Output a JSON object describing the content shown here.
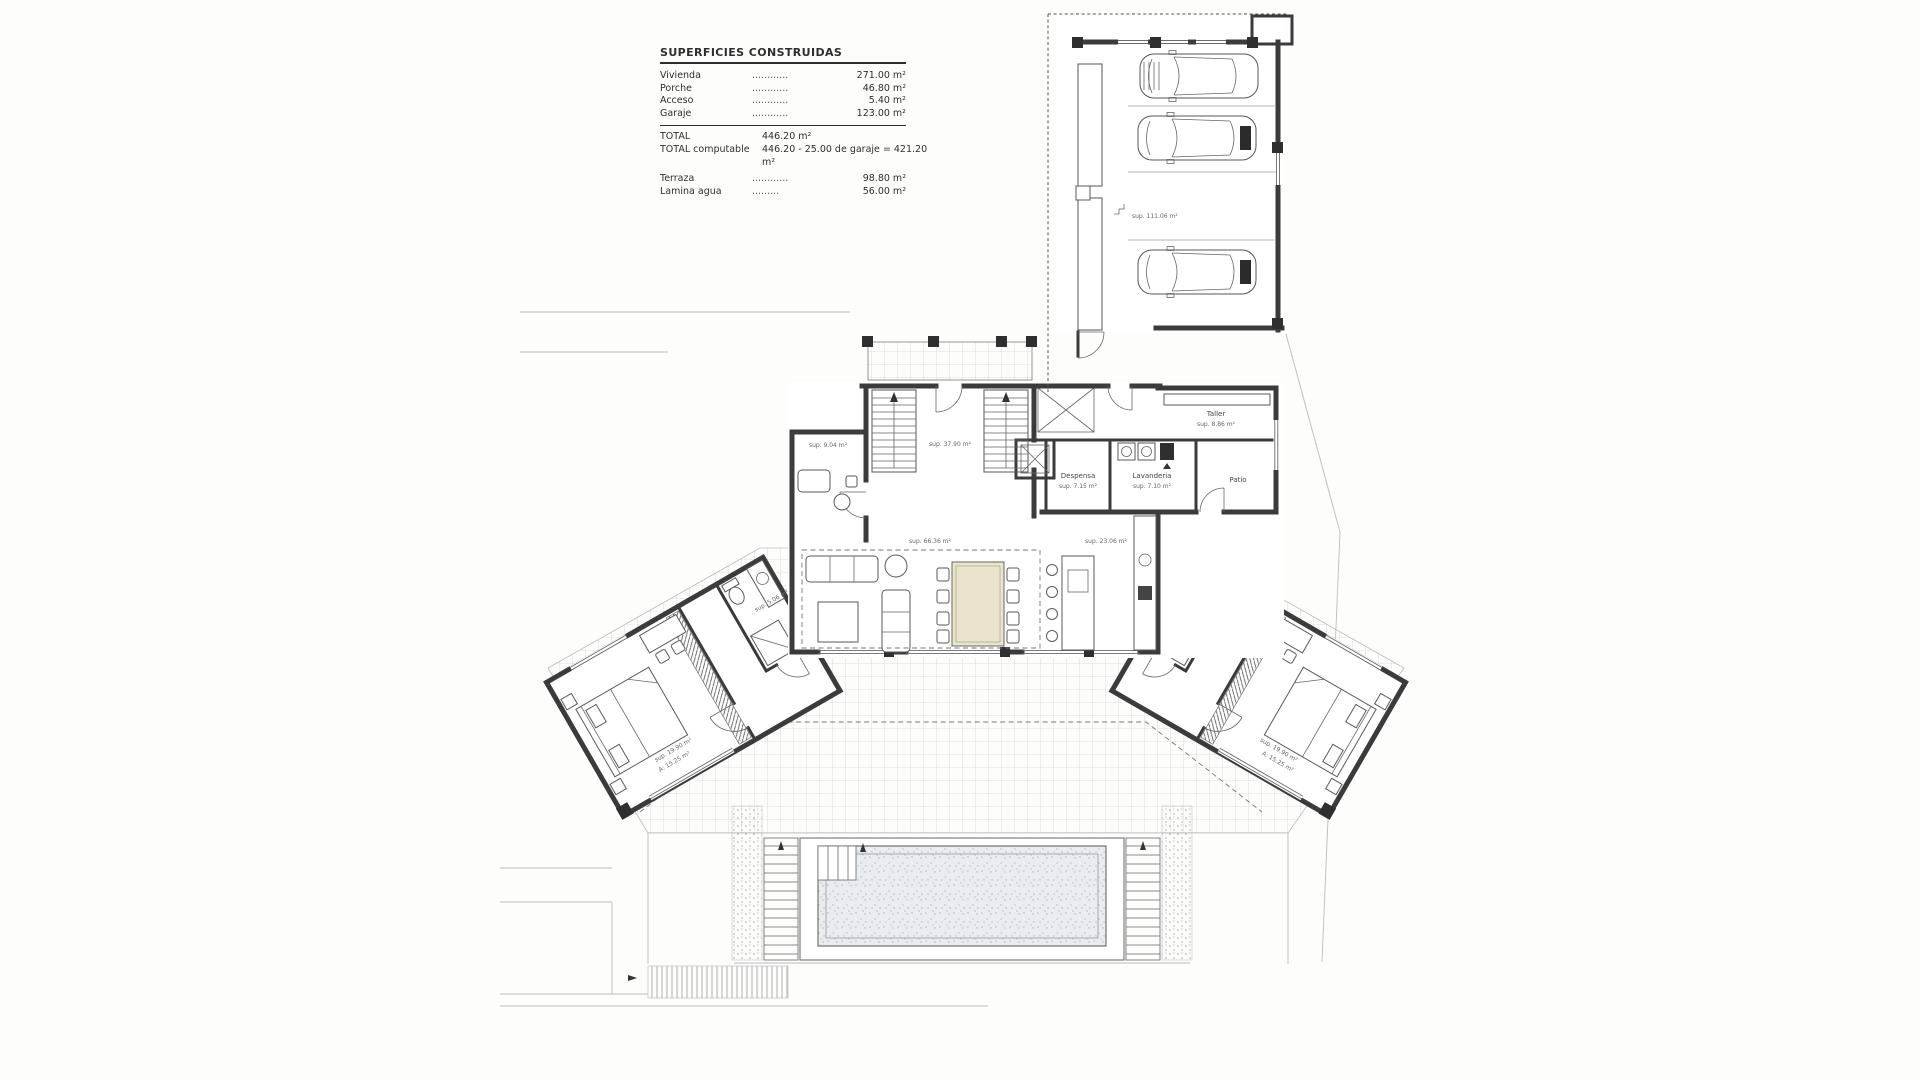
{
  "colors": {
    "wall": "#3b3b3b",
    "pool_water": "#e9edf1",
    "dining_table": "#e9e5cc",
    "tile_line": "#c6c6c6"
  },
  "legend": {
    "title": "SUPERFICIES CONSTRUIDAS",
    "rows": [
      {
        "name": "Vivienda",
        "leader": "............",
        "value": "271.00 m²"
      },
      {
        "name": "Porche",
        "leader": "............",
        "value": "46.80 m²"
      },
      {
        "name": "Acceso",
        "leader": "............",
        "value": "5.40 m²"
      },
      {
        "name": "Garaje",
        "leader": "............",
        "value": "123.00 m²"
      }
    ],
    "total": {
      "name": "TOTAL",
      "value": "446.20 m²"
    },
    "computable": {
      "name": "TOTAL computable",
      "value": "446.20 - 25.00 de garaje = 421.20 m²"
    },
    "extras": [
      {
        "name": "Terraza",
        "leader": "............",
        "value": "98.80 m²"
      },
      {
        "name": "Lamina agua",
        "leader": ".........",
        "value": "56.00 m²"
      }
    ]
  },
  "rooms": {
    "garaje_sup": "sup. 111.06 m²",
    "hall_sup": "sup. 37.90 m²",
    "estudio_sup": "sup. 9.04 m²",
    "salon_sup": "sup. 66.36 m²",
    "cocina_sup": "sup. 23.06 m²",
    "taller_name": "Taller",
    "taller_sup": "sup. 8.86 m²",
    "lavanderia_name": "Lavanderia",
    "lavanderia_sup": "sup. 7.10 m²",
    "despensa_name": "Despensa",
    "despensa_sup": "sup. 7.15 m²",
    "patio_name": "Patio",
    "bano_izq_sup": "sup. 5.06 m²",
    "dorm_izq_l1": "sup. 19.90 m²",
    "dorm_izq_l2": "A: 15.25 m²",
    "bano_der_sup": "sup. 5.06 m²",
    "dorm_der_l1": "sup. 19.90 m²",
    "dorm_der_l2": "A: 15.25 m²"
  }
}
